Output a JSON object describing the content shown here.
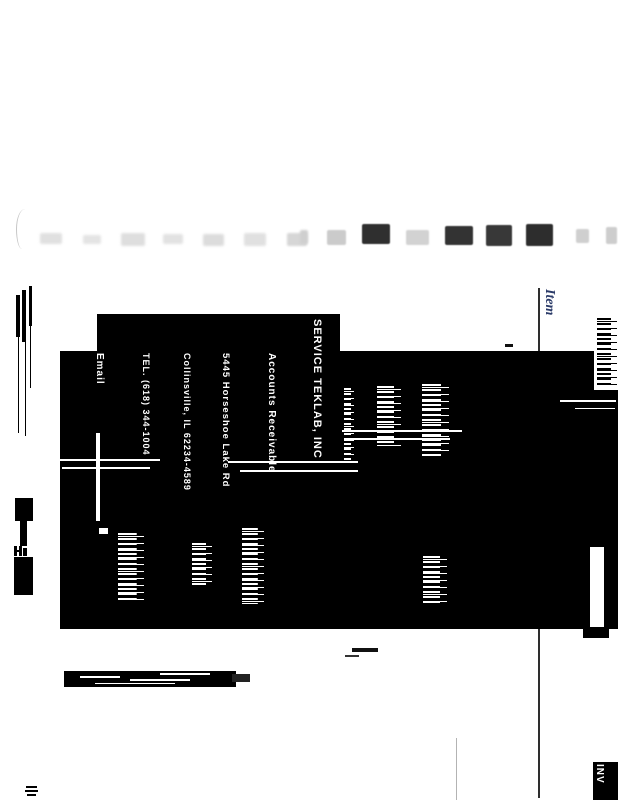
{
  "labels": {
    "item_column_header": "Item",
    "invoice_stub": "INV"
  },
  "remit": {
    "company": "SERVICE TEKLAB, INC",
    "department": "Accounts Receivable",
    "street": "5445 Horseshoe Lake Rd",
    "city_line": "Collinsville, IL 62234-4589",
    "phone": "TEL. (618) 344-1004",
    "email_label": "Email"
  },
  "colors": {
    "item_label": "#2a3a68",
    "ink": "#000000",
    "rule": "#2e2e2e",
    "faint_line": "#b3b3b3",
    "page_bg": "#ffffff"
  },
  "artifacts": {
    "smudges": [
      {
        "x": 40,
        "y": 233,
        "w": 22,
        "h": 11,
        "c": "#e0e0e0",
        "b": 1.2
      },
      {
        "x": 83,
        "y": 235,
        "w": 18,
        "h": 9,
        "c": "#e4e4e4",
        "b": 1.2
      },
      {
        "x": 121,
        "y": 233,
        "w": 24,
        "h": 13,
        "c": "#dedede",
        "b": 1.2
      },
      {
        "x": 163,
        "y": 234,
        "w": 20,
        "h": 10,
        "c": "#e2e2e2",
        "b": 1.2
      },
      {
        "x": 203,
        "y": 234,
        "w": 21,
        "h": 12,
        "c": "#dcdcdc",
        "b": 1.2
      },
      {
        "x": 244,
        "y": 233,
        "w": 22,
        "h": 13,
        "c": "#e0e0e0",
        "b": 1.2
      },
      {
        "x": 287,
        "y": 233,
        "w": 20,
        "h": 13,
        "c": "#d6d6d6",
        "b": 1.0
      },
      {
        "x": 300,
        "y": 230,
        "w": 8,
        "h": 14,
        "c": "#cfcfcf",
        "b": 1.0
      },
      {
        "x": 327,
        "y": 230,
        "w": 19,
        "h": 15,
        "c": "#cbcbcb",
        "b": 0.8
      },
      {
        "x": 362,
        "y": 224,
        "w": 28,
        "h": 20,
        "c": "#2f2f2f",
        "b": 0.4
      },
      {
        "x": 406,
        "y": 230,
        "w": 23,
        "h": 15,
        "c": "#d2d2d2",
        "b": 0.8
      },
      {
        "x": 445,
        "y": 226,
        "w": 28,
        "h": 19,
        "c": "#333333",
        "b": 0.4
      },
      {
        "x": 486,
        "y": 225,
        "w": 26,
        "h": 21,
        "c": "#383838",
        "b": 0.4
      },
      {
        "x": 526,
        "y": 224,
        "w": 27,
        "h": 22,
        "c": "#2d2d2d",
        "b": 0.4
      },
      {
        "x": 576,
        "y": 229,
        "w": 13,
        "h": 14,
        "c": "#cfcfcf",
        "b": 0.9
      },
      {
        "x": 606,
        "y": 227,
        "w": 11,
        "h": 17,
        "c": "#cdcdcd",
        "b": 0.9
      }
    ],
    "bars": [
      {
        "x": 16,
        "y": 295,
        "w": 4,
        "h": 42,
        "c": "#000"
      },
      {
        "x": 22,
        "y": 290,
        "w": 4,
        "h": 52,
        "c": "#000"
      },
      {
        "x": 29,
        "y": 286,
        "w": 3,
        "h": 40,
        "c": "#000"
      },
      {
        "x": 18,
        "y": 337,
        "w": 1,
        "h": 96,
        "c": "#000"
      },
      {
        "x": 25,
        "y": 342,
        "w": 1,
        "h": 94,
        "c": "#000"
      },
      {
        "x": 30,
        "y": 326,
        "w": 1,
        "h": 62,
        "c": "#000"
      },
      {
        "x": 15,
        "y": 498,
        "w": 18,
        "h": 23,
        "c": "#000"
      },
      {
        "x": 20,
        "y": 521,
        "w": 7,
        "h": 25,
        "c": "#000"
      },
      {
        "x": 14,
        "y": 546,
        "w": 3,
        "h": 10,
        "c": "#000"
      },
      {
        "x": 19,
        "y": 546,
        "w": 3,
        "h": 10,
        "c": "#000"
      },
      {
        "x": 15,
        "y": 550,
        "w": 7,
        "h": 2,
        "c": "#000"
      },
      {
        "x": 23,
        "y": 548,
        "w": 4,
        "h": 8,
        "c": "#000"
      },
      {
        "x": 14,
        "y": 557,
        "w": 19,
        "h": 38,
        "c": "#000"
      },
      {
        "x": 29,
        "y": 580,
        "w": 4,
        "h": 10,
        "c": "#000"
      },
      {
        "x": 505,
        "y": 344,
        "w": 8,
        "h": 3,
        "c": "#111"
      },
      {
        "x": 352,
        "y": 648,
        "w": 26,
        "h": 4,
        "c": "#111"
      },
      {
        "x": 345,
        "y": 655,
        "w": 14,
        "h": 2,
        "c": "#333"
      },
      {
        "x": 64,
        "y": 671,
        "w": 172,
        "h": 16,
        "c": "#000"
      },
      {
        "x": 232,
        "y": 674,
        "w": 18,
        "h": 8,
        "c": "#222"
      },
      {
        "x": 80,
        "y": 676,
        "w": 40,
        "h": 2,
        "c": "#fff"
      },
      {
        "x": 130,
        "y": 679,
        "w": 60,
        "h": 2,
        "c": "#fff"
      },
      {
        "x": 95,
        "y": 683,
        "w": 80,
        "h": 1,
        "c": "#fff"
      },
      {
        "x": 160,
        "y": 673,
        "w": 50,
        "h": 2,
        "c": "#fff"
      },
      {
        "x": 26,
        "y": 786,
        "w": 11,
        "h": 2,
        "c": "#000"
      },
      {
        "x": 25,
        "y": 790,
        "w": 13,
        "h": 2,
        "c": "#000"
      },
      {
        "x": 27,
        "y": 794,
        "w": 9,
        "h": 2,
        "c": "#000"
      },
      {
        "x": 60,
        "y": 459,
        "w": 100,
        "h": 2,
        "c": "#fff"
      },
      {
        "x": 62,
        "y": 467,
        "w": 88,
        "h": 2,
        "c": "#fff"
      },
      {
        "x": 228,
        "y": 461,
        "w": 130,
        "h": 2,
        "c": "#fff"
      },
      {
        "x": 240,
        "y": 470,
        "w": 118,
        "h": 2,
        "c": "#fff"
      },
      {
        "x": 342,
        "y": 430,
        "w": 120,
        "h": 2,
        "c": "#fff"
      },
      {
        "x": 350,
        "y": 438,
        "w": 100,
        "h": 2,
        "c": "#fff"
      },
      {
        "x": 560,
        "y": 400,
        "w": 56,
        "h": 2,
        "c": "#fff"
      },
      {
        "x": 575,
        "y": 408,
        "w": 40,
        "h": 1,
        "c": "#fff"
      },
      {
        "x": 96,
        "y": 433,
        "w": 4,
        "h": 88,
        "c": "#fff"
      },
      {
        "x": 99,
        "y": 528,
        "w": 9,
        "h": 6,
        "c": "#fff"
      },
      {
        "x": 583,
        "y": 629,
        "w": 26,
        "h": 9,
        "c": "#000"
      }
    ],
    "noise": [
      {
        "x": 344,
        "y": 388,
        "w": 10,
        "h": 72,
        "c": "#ffffff"
      },
      {
        "x": 377,
        "y": 386,
        "w": 24,
        "h": 60,
        "c": "#ffffff"
      },
      {
        "x": 422,
        "y": 384,
        "w": 27,
        "h": 72,
        "c": "#ffffff"
      },
      {
        "x": 118,
        "y": 533,
        "w": 26,
        "h": 70,
        "c": "#ffffff"
      },
      {
        "x": 192,
        "y": 543,
        "w": 20,
        "h": 42,
        "c": "#ffffff"
      },
      {
        "x": 242,
        "y": 528,
        "w": 22,
        "h": 76,
        "c": "#ffffff"
      },
      {
        "x": 423,
        "y": 556,
        "w": 24,
        "h": 48,
        "c": "#ffffff"
      },
      {
        "x": 597,
        "y": 318,
        "w": 20,
        "h": 68,
        "c": "#000000"
      },
      {
        "x": 608,
        "y": 772,
        "w": 8,
        "h": 24,
        "c": "#ffffff"
      }
    ],
    "patches": [
      {
        "x": 594,
        "y": 351,
        "w": 24,
        "h": 39
      },
      {
        "x": 590,
        "y": 547,
        "w": 14,
        "h": 80
      }
    ]
  }
}
